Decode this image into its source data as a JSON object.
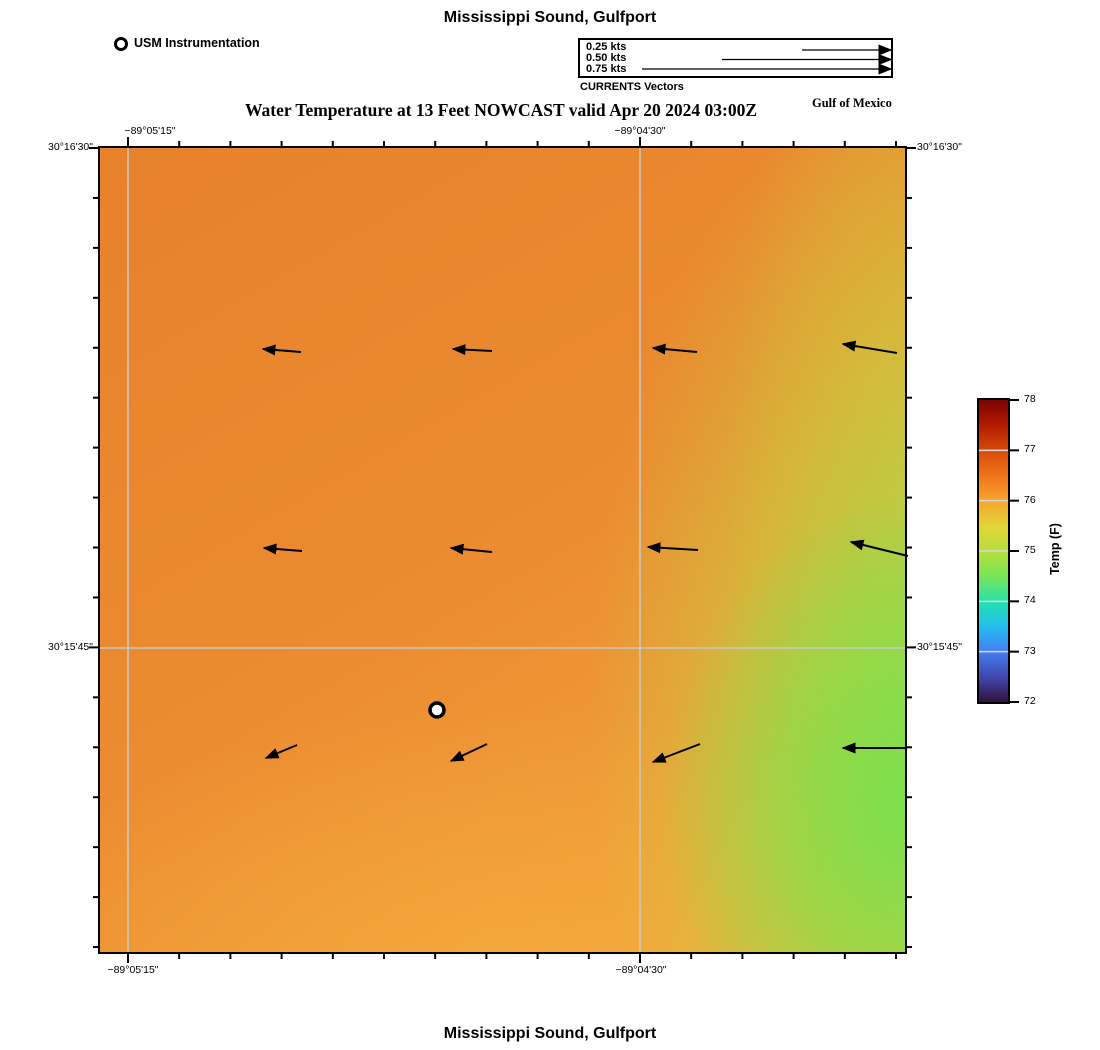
{
  "header": {
    "title": "Mississippi Sound, Gulfport",
    "subtitle": "Water Temperature at 13 Feet NOWCAST valid Apr 20 2024 03:00Z",
    "region_label": "Gulf of Mexico"
  },
  "footer": {
    "title": "Mississippi Sound, Gulfport"
  },
  "instrumentation_legend": {
    "label": "USM Instrumentation"
  },
  "currents_legend": {
    "caption": "CURRENTS Vectors",
    "arrow_end_x": 891,
    "entries": [
      {
        "label": "0.25 kts",
        "arrow_start_x": 802,
        "arrow_y": 50
      },
      {
        "label": "0.50 kts",
        "arrow_start_x": 722,
        "arrow_y": 59.5
      },
      {
        "label": "0.75 kts",
        "arrow_start_x": 642,
        "arrow_y": 69
      }
    ]
  },
  "map": {
    "frame": {
      "x": 100,
      "y": 148,
      "w": 805,
      "h": 804
    },
    "gridlines": {
      "vertical_x": [
        128,
        640
      ],
      "horizontal_y": [
        648
      ],
      "color": "#c9c9c9"
    },
    "ticks": {
      "x0": 128,
      "dx": 51.2,
      "y0": 148,
      "dy": 49.94,
      "minor_len": 7,
      "major_len": 11
    },
    "lon_labels": [
      {
        "text": "−89°05'15\"",
        "x": 150,
        "edge": "top"
      },
      {
        "text": "−89°04'30\"",
        "x": 640,
        "edge": "top"
      },
      {
        "text": "−89°05'15\"",
        "x": 133,
        "edge": "bottom"
      },
      {
        "text": "−89°04'30\"",
        "x": 641,
        "edge": "bottom"
      }
    ],
    "lat_labels": [
      {
        "text": "30°16'30\"",
        "y": 148,
        "side": "left"
      },
      {
        "text": "30°15'45\"",
        "y": 648,
        "side": "left"
      },
      {
        "text": "30°16'30\"",
        "y": 148,
        "side": "right"
      },
      {
        "text": "30°15'45\"",
        "y": 648,
        "side": "right"
      }
    ],
    "station_marker": {
      "x": 437,
      "y": 710,
      "r": 7
    },
    "vectors": [
      {
        "x1": 301,
        "y1": 352,
        "x2": 263,
        "y2": 349
      },
      {
        "x1": 492,
        "y1": 351,
        "x2": 453,
        "y2": 349
      },
      {
        "x1": 697,
        "y1": 352,
        "x2": 653,
        "y2": 348
      },
      {
        "x1": 897,
        "y1": 353,
        "x2": 843,
        "y2": 344
      },
      {
        "x1": 302,
        "y1": 551,
        "x2": 264,
        "y2": 548
      },
      {
        "x1": 492,
        "y1": 552,
        "x2": 451,
        "y2": 548
      },
      {
        "x1": 698,
        "y1": 550,
        "x2": 648,
        "y2": 547
      },
      {
        "x1": 908,
        "y1": 556,
        "x2": 851,
        "y2": 542
      },
      {
        "x1": 297,
        "y1": 745,
        "x2": 266,
        "y2": 758
      },
      {
        "x1": 487,
        "y1": 744,
        "x2": 451,
        "y2": 761
      },
      {
        "x1": 700,
        "y1": 744,
        "x2": 653,
        "y2": 762
      },
      {
        "x1": 905,
        "y1": 748,
        "x2": 843,
        "y2": 748
      }
    ],
    "field_colors": {
      "west_orange": "#e8832d",
      "center_orange": "#ee8f34",
      "south_yellow_orange": "#f3a83e",
      "east_yellow_green": "#c9d348",
      "southeast_green": "#7ee04f"
    }
  },
  "colorbar": {
    "x": 977,
    "y": 398,
    "w": 29,
    "h": 302,
    "label": "Temp (F)",
    "ticks": [
      78,
      77,
      76,
      75,
      74,
      73,
      72
    ],
    "stops": [
      {
        "p": 0,
        "color": "#7a0403"
      },
      {
        "p": 8,
        "color": "#b11901"
      },
      {
        "p": 17,
        "color": "#d84c08"
      },
      {
        "p": 25,
        "color": "#f0731d"
      },
      {
        "p": 33,
        "color": "#f7a22d"
      },
      {
        "p": 42,
        "color": "#e2d639"
      },
      {
        "p": 50,
        "color": "#b5de3c"
      },
      {
        "p": 58,
        "color": "#7ce556"
      },
      {
        "p": 67,
        "color": "#24e1b0"
      },
      {
        "p": 75,
        "color": "#25bdee"
      },
      {
        "p": 83,
        "color": "#4480f5"
      },
      {
        "p": 92,
        "color": "#4245ab"
      },
      {
        "p": 100,
        "color": "#30123b"
      }
    ]
  },
  "chart_data": {
    "type": "heatmap",
    "title": "Water Temperature at 13 Feet NOWCAST valid Apr 20 2024 03:00Z",
    "location": "Mississippi Sound, Gulfport",
    "valid_time": "Apr 20 2024 03:00Z",
    "depth_feet": 13,
    "x_ticks_longitude": [
      "−89°05'15\"",
      "−89°04'30\""
    ],
    "y_ticks_latitude": [
      "30°16'30\"",
      "30°15'45\""
    ],
    "colorbar": {
      "label": "Temp (F)",
      "min": 72,
      "max": 78,
      "ticks": [
        78,
        77,
        76,
        75,
        74,
        73,
        72
      ],
      "colormap": "turbo"
    },
    "temperature_grid_f": {
      "orientation": "rows north to south, columns west to east",
      "values": [
        [
          76.5,
          76.5,
          76.4,
          75.9
        ],
        [
          76.4,
          76.4,
          76.1,
          75.2
        ],
        [
          76.2,
          76.1,
          75.9,
          75.0
        ]
      ]
    },
    "current_vectors": {
      "grid": "4 columns x 3 rows",
      "direction": "westward; bottom row tilted west-southwest",
      "legend_speeds_kts": [
        0.25,
        0.5,
        0.75
      ],
      "estimated_speed_kts": [
        [
          0.1,
          0.11,
          0.12,
          0.15
        ],
        [
          0.1,
          0.11,
          0.14,
          0.17
        ],
        [
          0.09,
          0.11,
          0.14,
          0.18
        ]
      ]
    },
    "station": {
      "name": "USM Instrumentation",
      "marker": "open circle",
      "approx_position": "center-south of map"
    },
    "annotations": [
      "Gulf of Mexico",
      "CURRENTS Vectors"
    ]
  }
}
